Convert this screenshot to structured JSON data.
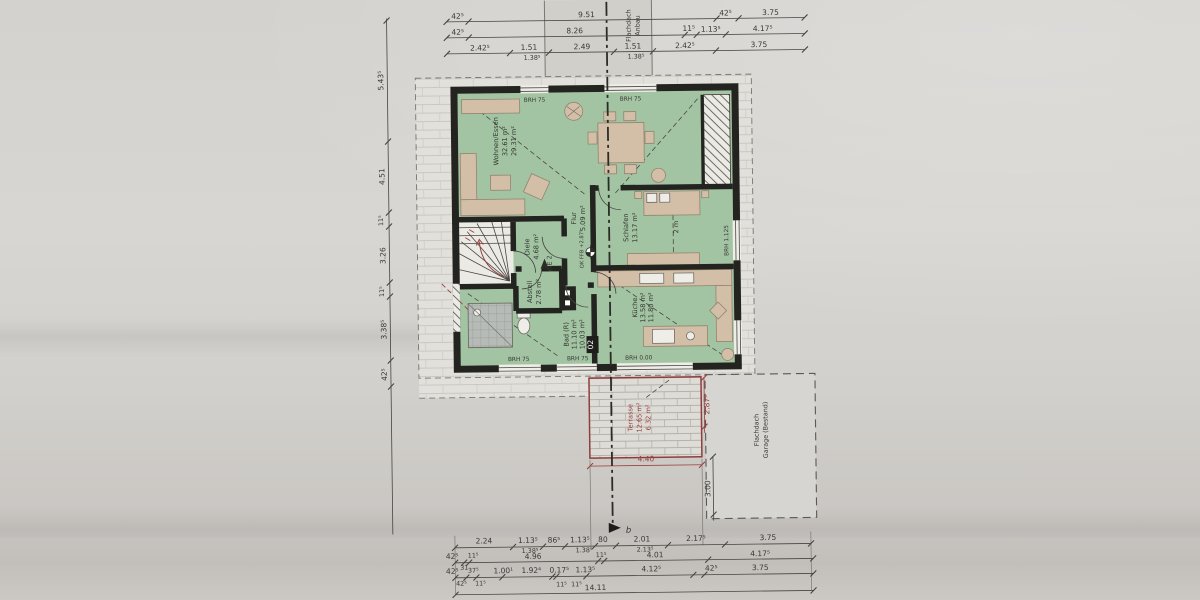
{
  "title": "Grundriss Obergeschoss (Bauplan-Foto)",
  "colors": {
    "paper": "#d5d3cf",
    "room_green": "#a2c4a3",
    "wall": "#23231f",
    "furniture": "#d3bfa8",
    "red_marking": "#9a4040",
    "dimension_text": "#3a3834"
  },
  "rooms": {
    "wohnen": {
      "name": "Wohnen/Essen",
      "area1": "32.61 m²",
      "area2": "29.31 m²"
    },
    "flur": {
      "name": "Flur",
      "area1": "5.09 m²"
    },
    "schlafen": {
      "name": "Schlafen",
      "area1": "13.17 m²",
      "extra": "2 m"
    },
    "diele": {
      "name": "Diele",
      "area1": "4.68 m²"
    },
    "abstell": {
      "name": "Abstell",
      "area1": "2.78 m²"
    },
    "bad": {
      "name": "Bad (R)",
      "area1": "11.10 m²",
      "area2": "10.03 m²"
    },
    "kueche": {
      "name": "Küche",
      "area1": "13.58 m²",
      "area2": "11.80 m²"
    },
    "terrasse": {
      "name": "Terrasse",
      "area1": "12.65 m²",
      "area2": "6.32 m²"
    }
  },
  "ann": {
    "brh75": "BRH 75",
    "brh000": "BRH 0.00",
    "brh1125": "BRH 1.125",
    "we2": "WE 2",
    "ok_ffb": "OK FFB +2.87⁵",
    "badge": "02",
    "section_b": "b",
    "anbau1": "Flachdach",
    "anbau2": "Anbau",
    "garage1": "Flachdach",
    "garage2": "Garage (Bestand)"
  },
  "dims": {
    "top1": [
      "42⁵",
      "9.51",
      "42⁵",
      "3.75"
    ],
    "top2": [
      "42⁵",
      "8.26",
      "11⁵",
      "1.13⁵",
      "4.17⁵"
    ],
    "top3": [
      "2.42⁵",
      "1.51",
      "1.38⁵",
      "2.49",
      "1.51",
      "1.38⁵",
      "2.42⁵",
      "3.75"
    ],
    "left": [
      "5.43⁵",
      "4.51",
      "11⁵",
      "3.26",
      "11⁵",
      "3.38⁵",
      "42⁵"
    ],
    "bot1": [
      "2.24",
      "1.13⁵",
      "1.38⁵",
      "86⁵",
      "1.13⁵",
      "1.38⁵",
      "80",
      "2.01",
      "2.13⁵",
      "2.17⁵",
      "3.75"
    ],
    "bot2": [
      "42⁵",
      "11⁵",
      "31",
      "4.96",
      "11⁵",
      "4.01",
      "4.17⁵"
    ],
    "bot3": [
      "42⁵",
      "37⁵",
      "42⁵",
      "11⁵",
      "1.00¹",
      "1.92⁴",
      "0.17⁵",
      "11⁵",
      "11⁵",
      "1.13⁵",
      "4.12⁵",
      "42⁵",
      "3.75"
    ],
    "total": "14.11",
    "terrace_w": "4.40",
    "terrace_h": "2.87⁵",
    "garage_side": "3.00"
  }
}
